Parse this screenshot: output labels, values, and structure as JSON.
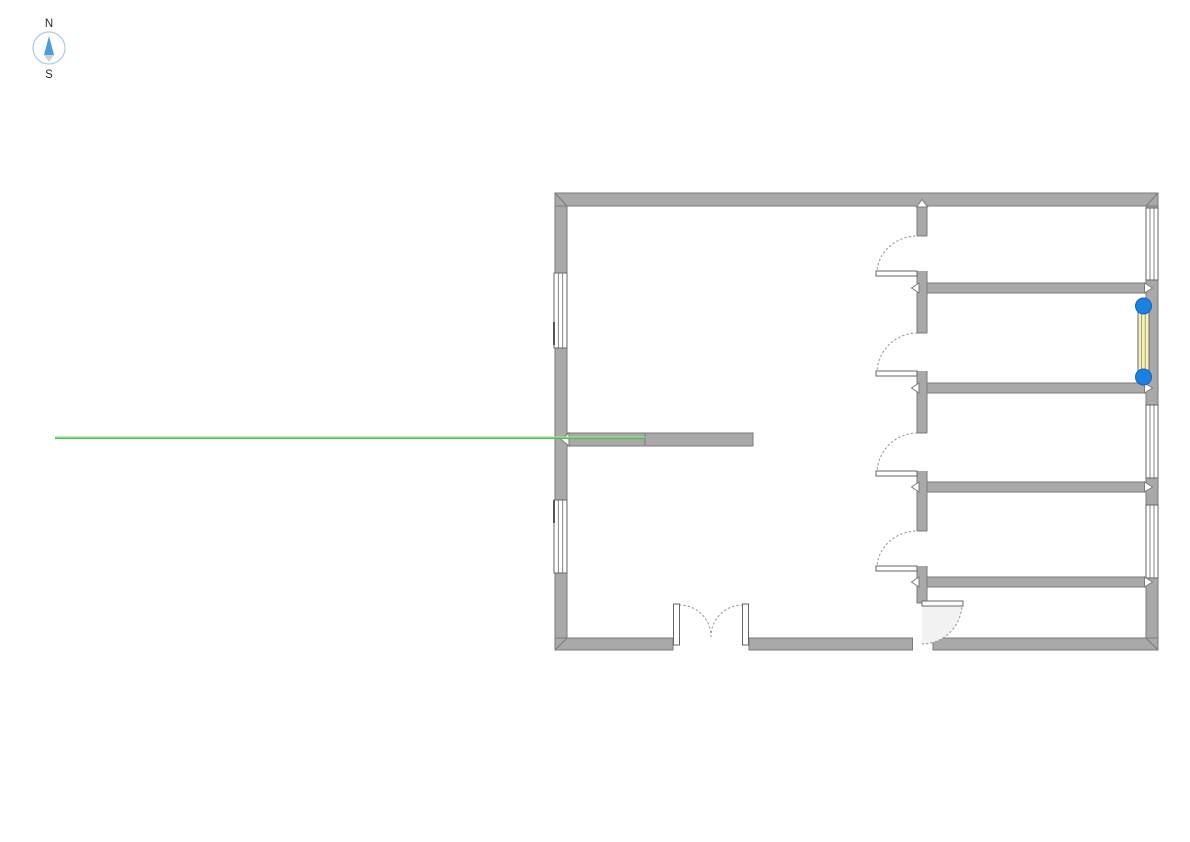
{
  "compass": {
    "north_label": "N",
    "south_label": "S"
  },
  "colors": {
    "background": "#ffffff",
    "wall_fill": "#a9a9a9",
    "wall_stroke": "#7a7a7a",
    "fixture_stroke": "#666666",
    "door_arc": "#9a9a9a",
    "guide_green": "#57bb57",
    "guide_green_light": "#9be49b",
    "selected_window_fill": "#f5f2c0",
    "selection_handle_blue": "#1d7fe0",
    "compass_ring": "#a8cbe4",
    "compass_needle_north": "#4a9edb",
    "compass_needle_south": "#d0d0d0"
  },
  "plan": {
    "type": "floor-plan",
    "rooms": [
      "main-hall",
      "room-northeast",
      "room-east-2",
      "room-east-3",
      "room-east-4",
      "room-southeast"
    ],
    "doors": [
      "door-room-ne",
      "door-room-e2",
      "door-room-e3",
      "door-room-e4",
      "door-room-se",
      "entrance-double-door"
    ],
    "windows": [
      "window-west-upper",
      "window-west-lower",
      "window-east-room-ne",
      "window-east-room-e2-selected",
      "window-east-room-e3",
      "window-east-room-e4"
    ],
    "selection": {
      "selected_element": "window-east-room-e2-selected",
      "handle_count": 2
    },
    "guides": {
      "horizontal_snap_guide": "active"
    }
  }
}
